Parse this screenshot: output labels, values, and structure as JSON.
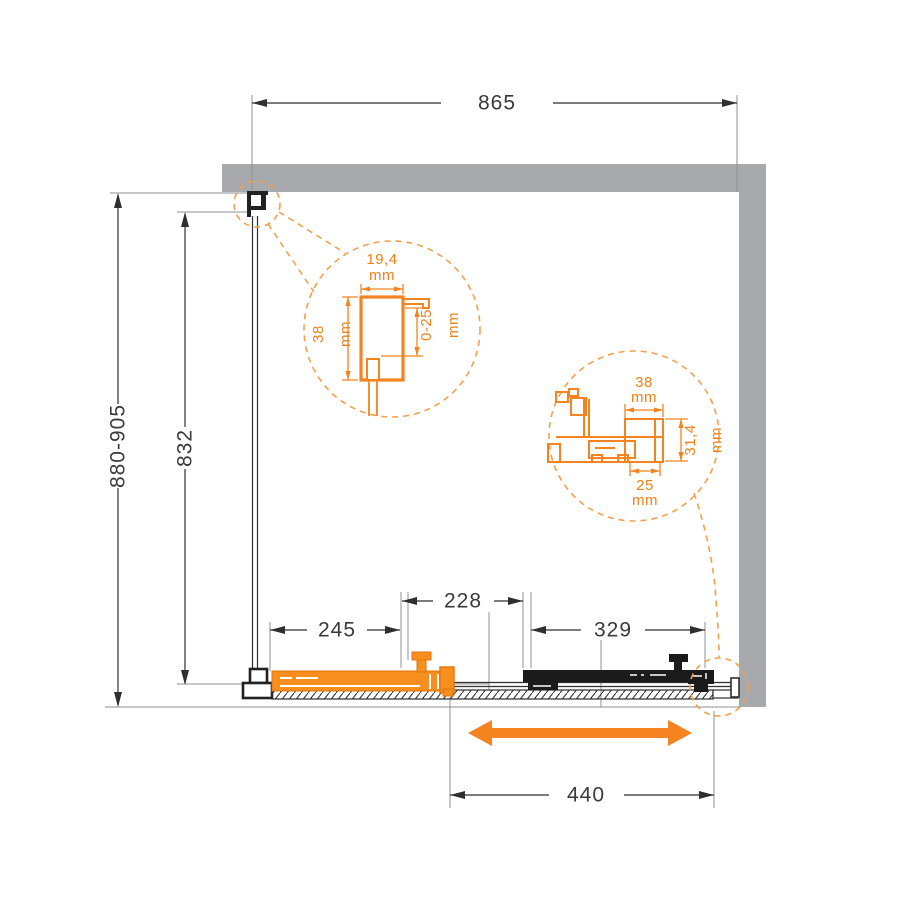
{
  "drawing": {
    "kind": "shower-enclosure-installation-diagram-top-view",
    "dimensions": {
      "overall_width": "865",
      "overall_height_range": "880-905",
      "glass_height": "832",
      "fixed_segment": "245",
      "overlap_segment": "228",
      "door_segment": "329",
      "door_travel": "440"
    },
    "detail_wall_profile": {
      "width_value": "19,4",
      "height_value": "38",
      "adjust_value": "0-25",
      "unit": "mm"
    },
    "detail_rail_profile": {
      "top_width_value": "38",
      "height_value": "31,4",
      "inner_width_value": "25",
      "unit": "mm"
    },
    "colors": {
      "accent_orange": "#F5831F",
      "door_orange": "#F78E1E",
      "wall_gray": "#A7A9AC",
      "line_dark": "#2F2F2F"
    }
  }
}
